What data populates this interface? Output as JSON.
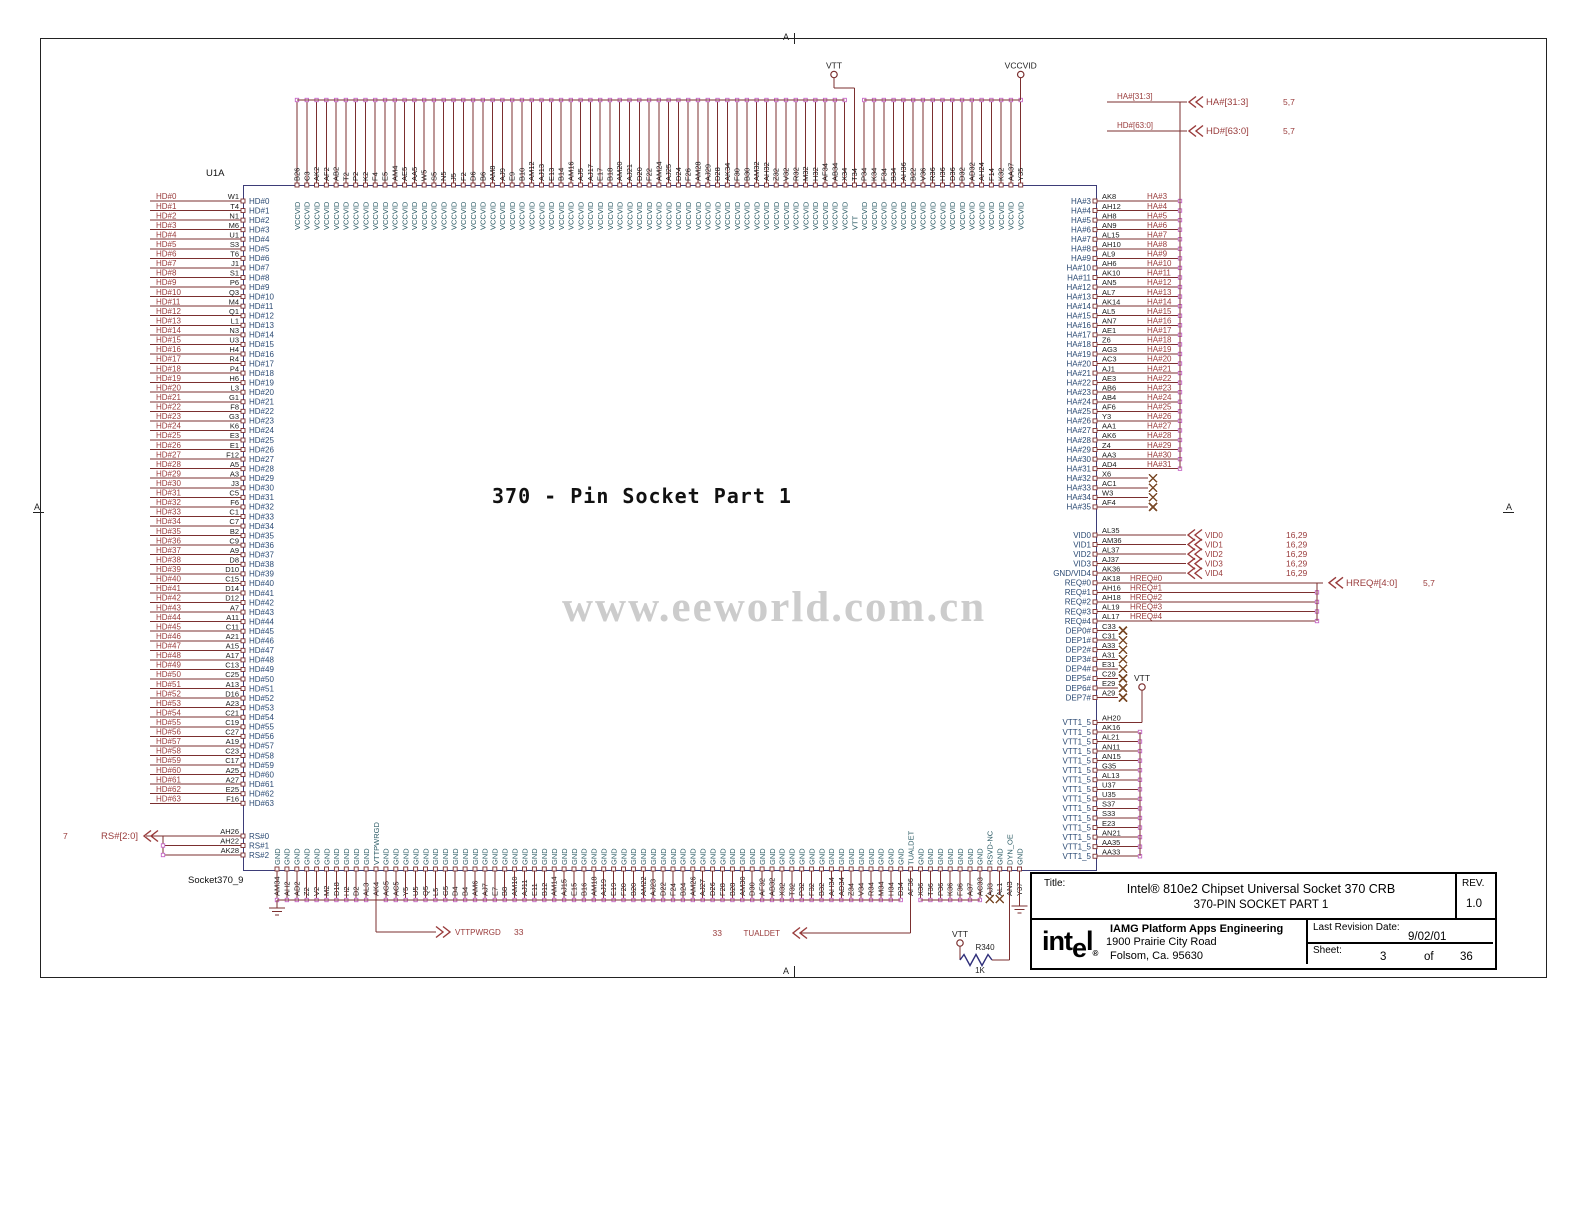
{
  "sheet": {
    "marker": "A",
    "center_title": "370 - Pin Socket Part 1",
    "watermark": "www.eeworld.com.cn",
    "component_ref": "U1A",
    "component_part": "Socket370_9"
  },
  "colors": {
    "wire": "#7b2f2f",
    "net_label": "#993b3b",
    "pin_number": "#1a1a1a",
    "pin_name_side": "#2b4a73",
    "pin_name_vert": "#2d5c66",
    "hook": "#c566c5",
    "no_connect": "#7a4a28",
    "box_border": "#3d3d78",
    "resistor_body": "#2f2f7a",
    "watermark": "#cccccc"
  },
  "power": {
    "vtt": "VTT",
    "vccvid": "VCCVID"
  },
  "buses": {
    "ha": {
      "net": "HA#[31:3]",
      "conn": "HA#[31:3]",
      "ref": "5,7"
    },
    "hd": {
      "net": "HD#[63:0]",
      "conn": "HD#[63:0]",
      "ref": "5,7"
    },
    "hreq": {
      "conn": "HREQ#[4:0]",
      "ref": "5,7"
    },
    "rs": {
      "conn": "RS#[2:0]",
      "ref": "7"
    },
    "vid_ref": "16,29"
  },
  "signals": {
    "vttpwrgd": {
      "label": "VTTPWRGD",
      "sheet": "33"
    },
    "tualdet": {
      "label": "TUALDET",
      "sheet": "33"
    }
  },
  "resistor": {
    "ref": "R340",
    "value": "1K"
  },
  "left_pins": [
    [
      "HD#0",
      "W1"
    ],
    [
      "HD#1",
      "T4"
    ],
    [
      "HD#2",
      "N1"
    ],
    [
      "HD#3",
      "M6"
    ],
    [
      "HD#4",
      "U1"
    ],
    [
      "HD#5",
      "S3"
    ],
    [
      "HD#6",
      "T6"
    ],
    [
      "HD#7",
      "J1"
    ],
    [
      "HD#8",
      "S1"
    ],
    [
      "HD#9",
      "P6"
    ],
    [
      "HD#10",
      "Q3"
    ],
    [
      "HD#11",
      "M4"
    ],
    [
      "HD#12",
      "Q1"
    ],
    [
      "HD#13",
      "L1"
    ],
    [
      "HD#14",
      "N3"
    ],
    [
      "HD#15",
      "U3"
    ],
    [
      "HD#16",
      "H4"
    ],
    [
      "HD#17",
      "R4"
    ],
    [
      "HD#18",
      "P4"
    ],
    [
      "HD#19",
      "H6"
    ],
    [
      "HD#20",
      "L3"
    ],
    [
      "HD#21",
      "G1"
    ],
    [
      "HD#22",
      "F8"
    ],
    [
      "HD#23",
      "G3"
    ],
    [
      "HD#24",
      "K6"
    ],
    [
      "HD#25",
      "E3"
    ],
    [
      "HD#26",
      "E1"
    ],
    [
      "HD#27",
      "F12"
    ],
    [
      "HD#28",
      "A5"
    ],
    [
      "HD#29",
      "A3"
    ],
    [
      "HD#30",
      "J3"
    ],
    [
      "HD#31",
      "C5"
    ],
    [
      "HD#32",
      "F6"
    ],
    [
      "HD#33",
      "C1"
    ],
    [
      "HD#34",
      "C7"
    ],
    [
      "HD#35",
      "B2"
    ],
    [
      "HD#36",
      "C9"
    ],
    [
      "HD#37",
      "A9"
    ],
    [
      "HD#38",
      "D8"
    ],
    [
      "HD#39",
      "D10"
    ],
    [
      "HD#40",
      "C15"
    ],
    [
      "HD#41",
      "D14"
    ],
    [
      "HD#42",
      "D12"
    ],
    [
      "HD#43",
      "A7"
    ],
    [
      "HD#44",
      "A11"
    ],
    [
      "HD#45",
      "C11"
    ],
    [
      "HD#46",
      "A21"
    ],
    [
      "HD#47",
      "A15"
    ],
    [
      "HD#48",
      "A17"
    ],
    [
      "HD#49",
      "C13"
    ],
    [
      "HD#50",
      "C25"
    ],
    [
      "HD#51",
      "A13"
    ],
    [
      "HD#52",
      "D16"
    ],
    [
      "HD#53",
      "A23"
    ],
    [
      "HD#54",
      "C21"
    ],
    [
      "HD#55",
      "C19"
    ],
    [
      "HD#56",
      "C27"
    ],
    [
      "HD#57",
      "A19"
    ],
    [
      "HD#58",
      "C23"
    ],
    [
      "HD#59",
      "C17"
    ],
    [
      "HD#60",
      "A25"
    ],
    [
      "HD#61",
      "A27"
    ],
    [
      "HD#62",
      "E25"
    ],
    [
      "HD#63",
      "F16"
    ]
  ],
  "rs_pins": [
    [
      "RS#0",
      "AH26"
    ],
    [
      "RS#1",
      "AH22"
    ],
    [
      "RS#2",
      "AK28"
    ]
  ],
  "top": {
    "default_net": "VCCVID",
    "special": {
      "T34": "VTT"
    },
    "pins": [
      "B26",
      "C3",
      "AK2",
      "AF2",
      "AB2",
      "T2",
      "P2",
      "K2",
      "F4",
      "E5",
      "AM4",
      "AE5",
      "AA5",
      "W5",
      "S5",
      "N5",
      "J5",
      "F2",
      "D6",
      "B6",
      "AM8",
      "AJ9",
      "E9",
      "B10",
      "AM12",
      "AJ13",
      "E13",
      "B14",
      "AM16",
      "AJ5",
      "AJ17",
      "E17",
      "B18",
      "AM20",
      "AJ21",
      "D20",
      "F22",
      "AM24",
      "AJ25",
      "D24",
      "F26",
      "AM28",
      "AJ29",
      "D28",
      "AK34",
      "F30",
      "B30",
      "AM32",
      "AH32",
      "Z32",
      "V32",
      "R32",
      "M32",
      "H32",
      "AF34",
      "AB34",
      "X34",
      "T34",
      "P34",
      "K34",
      "F34",
      "B34",
      "AH36",
      "B22",
      "V36",
      "R36",
      "H36",
      "D36",
      "D32",
      "AD32",
      "AH24",
      "F14",
      "K32",
      "AA37",
      "Y35"
    ]
  },
  "bottom": {
    "default_net": "GND",
    "special": {
      "AK4": "VTTPWRGD",
      "AF36": "TUALDET",
      "AJ3": "RSVD-NC",
      "AN3": "DYN_OE"
    },
    "no_connect": [
      "AJ3",
      "AL1"
    ],
    "pins": [
      "AM34",
      "AH2",
      "AD2",
      "Z2",
      "V2",
      "M2",
      "D18",
      "H2",
      "D2",
      "AL3",
      "AK4",
      "AG5",
      "AC5",
      "Y5",
      "U5",
      "Q5",
      "L5",
      "G5",
      "D4",
      "B4",
      "AM6",
      "AJ7",
      "E7",
      "B8",
      "AM10",
      "AJ11",
      "E11",
      "B12",
      "AM14",
      "AJ15",
      "E15",
      "B16",
      "AM18",
      "AJ19",
      "E19",
      "F20",
      "B20",
      "AM22",
      "AJ23",
      "D22",
      "F24",
      "B24",
      "AM26",
      "AJ27",
      "D26",
      "F28",
      "B28",
      "AM30",
      "D30",
      "AF32",
      "AB32",
      "X32",
      "T32",
      "P32",
      "F32",
      "B32",
      "AH34",
      "AD34",
      "Z34",
      "V34",
      "R34",
      "M34",
      "H34",
      "D34",
      "AF36",
      "X36",
      "T36",
      "P36",
      "K36",
      "F36",
      "A37",
      "AC33",
      "AJ3",
      "AL1",
      "AN3",
      "Y37"
    ]
  },
  "ha_pins": [
    [
      "HA#3",
      "AK8"
    ],
    [
      "HA#4",
      "AH12"
    ],
    [
      "HA#5",
      "AH8"
    ],
    [
      "HA#6",
      "AN9"
    ],
    [
      "HA#7",
      "AL15"
    ],
    [
      "HA#8",
      "AH10"
    ],
    [
      "HA#9",
      "AL9"
    ],
    [
      "HA#10",
      "AH6"
    ],
    [
      "HA#11",
      "AK10"
    ],
    [
      "HA#12",
      "AN5"
    ],
    [
      "HA#13",
      "AL7"
    ],
    [
      "HA#14",
      "AK14"
    ],
    [
      "HA#15",
      "AL5"
    ],
    [
      "HA#16",
      "AN7"
    ],
    [
      "HA#17",
      "AE1"
    ],
    [
      "HA#18",
      "Z6"
    ],
    [
      "HA#19",
      "AG3"
    ],
    [
      "HA#20",
      "AC3"
    ],
    [
      "HA#21",
      "AJ1"
    ],
    [
      "HA#22",
      "AE3"
    ],
    [
      "HA#23",
      "AB6"
    ],
    [
      "HA#24",
      "AB4"
    ],
    [
      "HA#25",
      "AF6"
    ],
    [
      "HA#26",
      "Y3"
    ],
    [
      "HA#27",
      "AA1"
    ],
    [
      "HA#28",
      "AK6"
    ],
    [
      "HA#29",
      "Z4"
    ],
    [
      "HA#30",
      "AA3"
    ],
    [
      "HA#31",
      "AD4"
    ],
    [
      "HA#32",
      "X6"
    ],
    [
      "HA#33",
      "AC1"
    ],
    [
      "HA#34",
      "W3"
    ],
    [
      "HA#35",
      "AF4"
    ]
  ],
  "ha_no_connect": [
    "HA#32",
    "HA#33",
    "HA#34",
    "HA#35"
  ],
  "vid_pins": [
    [
      "VID0",
      "AL35",
      "VID0"
    ],
    [
      "VID1",
      "AM36",
      "VID1"
    ],
    [
      "VID2",
      "AL37",
      "VID2"
    ],
    [
      "VID3",
      "AJ37",
      "VID3"
    ],
    [
      "GND/VID4",
      "AK36",
      "VID4"
    ]
  ],
  "req_pins": [
    [
      "REQ#0",
      "AK18",
      "HREQ#0"
    ],
    [
      "REQ#1",
      "AH16",
      "HREQ#1"
    ],
    [
      "REQ#2",
      "AH18",
      "HREQ#2"
    ],
    [
      "REQ#3",
      "AL19",
      "HREQ#3"
    ],
    [
      "REQ#4",
      "AL17",
      "HREQ#4"
    ]
  ],
  "dep_pins": [
    [
      "DEP0#",
      "C33"
    ],
    [
      "DEP1#",
      "C31"
    ],
    [
      "DEP2#",
      "A33"
    ],
    [
      "DEP3#",
      "A31"
    ],
    [
      "DEP4#",
      "E31"
    ],
    [
      "DEP5#",
      "C29"
    ],
    [
      "DEP6#",
      "E29"
    ],
    [
      "DEP7#",
      "A29"
    ]
  ],
  "vtt_pins_name": "VTT1_5",
  "vtt_pins": [
    "AH20",
    "AK16",
    "AL21",
    "AN11",
    "AN15",
    "G35",
    "AL13",
    "U37",
    "U35",
    "S37",
    "S33",
    "E23",
    "AN21",
    "AA35",
    "AA33"
  ],
  "title_block": {
    "title_label": "Title:",
    "title_line1": "Intel® 810e2 Chipset Universal Socket 370 CRB",
    "title_line2": "370-PIN SOCKET PART 1",
    "rev_label": "REV.",
    "rev": "1.0",
    "logo_pre": "int",
    "logo_e": "e",
    "logo_post": "l",
    "logo_reg": "®",
    "org": "IAMG Platform Apps Engineering",
    "addr1": "1900 Prairie City Road",
    "addr2": "Folsom, Ca. 95630",
    "last_rev_label": "Last Revision Date:",
    "last_rev": "9/02/01",
    "sheet_label": "Sheet:",
    "sheet_num": "3",
    "of_label": "of",
    "sheet_total": "36"
  }
}
